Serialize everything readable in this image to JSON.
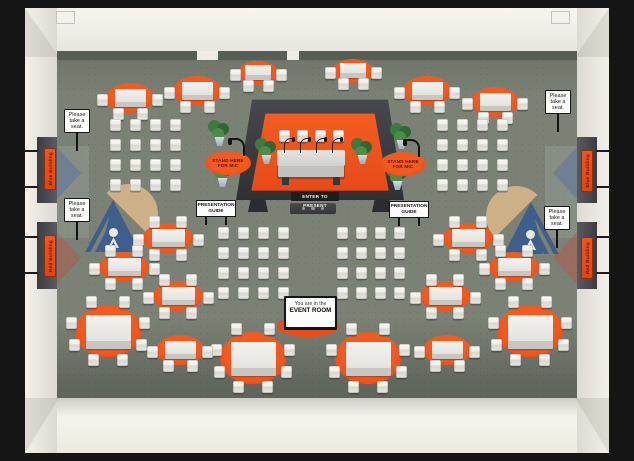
{
  "room": {
    "type": "virtual-event-room",
    "colors": {
      "floor": "#7b8275",
      "accent_orange": "#ea4d17",
      "stage_platform": "#3a3a3e",
      "outer_wall": "#f2f0e8",
      "frame": "#151515",
      "logo_blue": "#3e5f8c",
      "logo_tan": "#cdb086",
      "banner_text": "#6b1a06"
    }
  },
  "labels": {
    "enter_to_present": "ENTER TO PRESENT",
    "stand_here_for_mic_line1": "STAND HERE",
    "stand_here_for_mic_line2": "FOR MIC",
    "presentation_guide_line1": "PRESENTATION",
    "presentation_guide_line2": "GUIDE",
    "please_seat_line1": "Please",
    "please_seat_line2": "take a",
    "please_seat_line3": "seat.",
    "room_sign_line1": "You are in the",
    "room_sign_line2": "EVENT ROOM",
    "blue_building": "Blue Building",
    "red_building": "Red Building"
  },
  "furniture": {
    "tables": [
      {
        "x": 130,
        "y": 98,
        "rx": 24,
        "ry": 15,
        "seats": 4
      },
      {
        "x": 197,
        "y": 91,
        "rx": 24,
        "ry": 15,
        "seats": 4
      },
      {
        "x": 258,
        "y": 73,
        "rx": 20,
        "ry": 12,
        "seats": 4
      },
      {
        "x": 353,
        "y": 71,
        "rx": 20,
        "ry": 12,
        "seats": 4
      },
      {
        "x": 427,
        "y": 91,
        "rx": 24,
        "ry": 15,
        "seats": 4
      },
      {
        "x": 495,
        "y": 102,
        "rx": 24,
        "ry": 15,
        "seats": 4
      },
      {
        "x": 168,
        "y": 238,
        "rx": 25,
        "ry": 15,
        "seats": 6
      },
      {
        "x": 124,
        "y": 267,
        "rx": 25,
        "ry": 15,
        "seats": 6
      },
      {
        "x": 178,
        "y": 296,
        "rx": 25,
        "ry": 15,
        "seats": 6
      },
      {
        "x": 468,
        "y": 238,
        "rx": 25,
        "ry": 15,
        "seats": 6
      },
      {
        "x": 514,
        "y": 267,
        "rx": 25,
        "ry": 15,
        "seats": 6
      },
      {
        "x": 445,
        "y": 296,
        "rx": 25,
        "ry": 15,
        "seats": 6
      },
      {
        "x": 108,
        "y": 331,
        "rx": 33,
        "ry": 26,
        "seats": 8
      },
      {
        "x": 530,
        "y": 331,
        "rx": 33,
        "ry": 26,
        "seats": 8
      },
      {
        "x": 253,
        "y": 358,
        "rx": 33,
        "ry": 26,
        "seats": 8
      },
      {
        "x": 368,
        "y": 358,
        "rx": 33,
        "ry": 26,
        "seats": 8
      },
      {
        "x": 180,
        "y": 350,
        "rx": 24,
        "ry": 15,
        "seats": 4
      },
      {
        "x": 447,
        "y": 350,
        "rx": 24,
        "ry": 15,
        "seats": 4
      }
    ],
    "chair_blocks": [
      {
        "x": 115,
        "y": 125,
        "cols": 4,
        "rows": 4,
        "dx": 20,
        "dy": 20
      },
      {
        "x": 442,
        "y": 125,
        "cols": 4,
        "rows": 4,
        "dx": 20,
        "dy": 20
      },
      {
        "x": 223,
        "y": 233,
        "cols": 4,
        "rows": 4,
        "dx": 20,
        "dy": 20
      },
      {
        "x": 342,
        "y": 233,
        "cols": 4,
        "rows": 4,
        "dx": 19,
        "dy": 20
      }
    ],
    "seat_signs": [
      {
        "x": 77,
        "y": 123
      },
      {
        "x": 77,
        "y": 212
      },
      {
        "x": 558,
        "y": 104
      },
      {
        "x": 557,
        "y": 220
      }
    ],
    "guide_signs": [
      {
        "x": 216,
        "y": 208
      },
      {
        "x": 409,
        "y": 209
      }
    ],
    "mic_spots": [
      {
        "x": 228,
        "y": 163
      },
      {
        "x": 403,
        "y": 164
      }
    ],
    "plants": [
      {
        "x": 219,
        "y": 140
      },
      {
        "x": 222,
        "y": 181
      },
      {
        "x": 266,
        "y": 158
      },
      {
        "x": 362,
        "y": 158
      },
      {
        "x": 401,
        "y": 143
      },
      {
        "x": 397,
        "y": 184
      }
    ],
    "banners": [
      {
        "side": "left",
        "y": 148,
        "label": "blue_building"
      },
      {
        "side": "left",
        "y": 235,
        "label": "red_building"
      },
      {
        "side": "right",
        "y": 150,
        "label": "blue_building"
      },
      {
        "side": "right",
        "y": 237,
        "label": "red_building"
      }
    ]
  }
}
